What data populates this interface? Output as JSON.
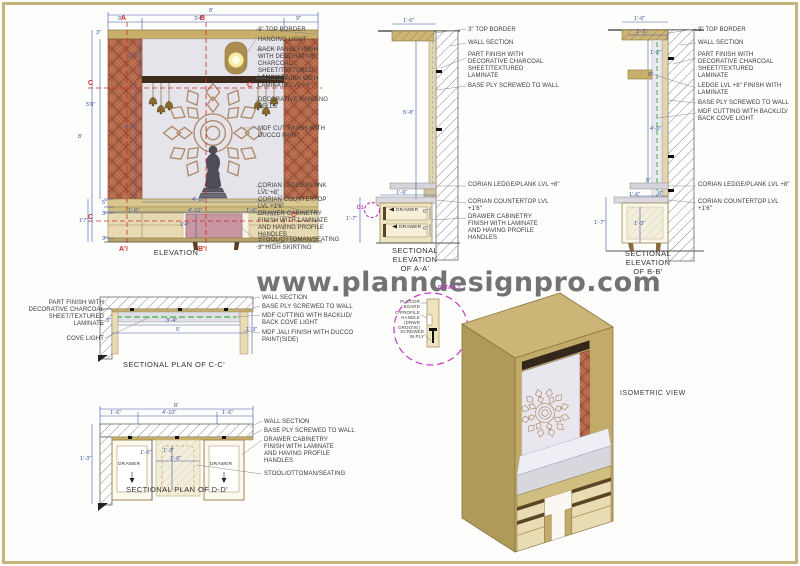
{
  "watermark": "www.planndesignpro.com",
  "colors": {
    "sheet_border": "#c7b37c",
    "wood": "#c8b06a",
    "terracotta": "#b5684a",
    "back_panel": "#e4e4ea",
    "stool_pink": "#c997a2",
    "dim_blue": "#3c55a5",
    "marker_red": "#cc2a2a",
    "cove_green": "#5cbb5c",
    "detail_magenta": "#c03cc0"
  },
  "annotations": {
    "elevation": [
      {
        "n": "elev-label-top-border",
        "t": "3\" TOP BORDER",
        "x": 258,
        "y": 27,
        "w": 76
      },
      {
        "n": "elev-label-hanging-light",
        "t": "HANGING LIGHT",
        "x": 258,
        "y": 37,
        "w": 76
      },
      {
        "n": "elev-label-back-panel",
        "t": "BACK PANEL FINISH WITH DECORATIVE CHARCOAL SHEET/TEXTURED LAMINATE",
        "x": 258,
        "y": 47,
        "w": 76
      },
      {
        "n": "elev-label-ledge",
        "t": "LEDGE FINISH WITH LAMINATE LVL +8\"",
        "x": 258,
        "y": 76,
        "w": 76
      },
      {
        "n": "elev-label-bells",
        "t": "DECORATIVE HANGING BELLS",
        "x": 258,
        "y": 97,
        "w": 76
      },
      {
        "n": "elev-label-mdf-cut",
        "t": "MDF CUT FINISH WITH DUCCO PAINT",
        "x": 258,
        "y": 126,
        "w": 76
      },
      {
        "n": "elev-label-corian-ledge",
        "t": "CORIAN LEDGE/PLANK LVL +8\"",
        "x": 258,
        "y": 183,
        "w": 76
      },
      {
        "n": "elev-label-corian-countertop",
        "t": "CORIAN COUNTERTOP LVL +1'6\"",
        "x": 258,
        "y": 197,
        "w": 76
      },
      {
        "n": "elev-label-drawer-cabinetry",
        "t": "DRAWER CABINETRY FINISH WITH LAMINATE AND HAVING PROFILE HANDLES",
        "x": 258,
        "y": 211,
        "w": 72
      },
      {
        "n": "elev-label-stool",
        "t": "STOOL/OTTOMAN/SEATING",
        "x": 258,
        "y": 237,
        "w": 92
      },
      {
        "n": "elev-label-skirting",
        "t": "3\" HIGH SKIRTING",
        "x": 258,
        "y": 245,
        "w": 92
      },
      {
        "n": "elev-title",
        "t": "ELEVATION",
        "x": 141,
        "y": 249,
        "w": 70,
        "c": "title"
      },
      {
        "n": "elev-dim-total-width",
        "t": "8'",
        "x": 209,
        "y": 8,
        "c": "dim"
      },
      {
        "n": "elev-dim-left-col",
        "t": "9\"",
        "x": 118,
        "y": 16,
        "c": "dim"
      },
      {
        "n": "elev-dim-niche",
        "t": "3'4\"",
        "x": 194,
        "y": 16,
        "c": "dim"
      },
      {
        "n": "elev-dim-right-col",
        "t": "9\"",
        "x": 296,
        "y": 16,
        "c": "dim"
      },
      {
        "n": "elev-dim-border",
        "t": "3\"",
        "x": 96,
        "y": 30,
        "c": "dim"
      },
      {
        "n": "elev-dim-upper",
        "t": "1'-2\"",
        "x": 128,
        "y": 53,
        "c": "dim"
      },
      {
        "n": "elev-dim-58",
        "t": "5'8\"",
        "x": 86,
        "y": 102,
        "c": "dim"
      },
      {
        "n": "elev-dim-47",
        "t": "4'-7\"",
        "x": 124,
        "y": 124,
        "c": "dim"
      },
      {
        "n": "elev-dim-height",
        "t": "8'",
        "x": 78,
        "y": 134,
        "c": "dim"
      },
      {
        "n": "elev-dim-17",
        "t": "1'7\"",
        "x": 79,
        "y": 218,
        "c": "dim"
      },
      {
        "n": "elev-dim-5",
        "t": "5\"",
        "x": 102,
        "y": 200,
        "c": "dim"
      },
      {
        "n": "elev-dim-3a",
        "t": "3\"",
        "x": 102,
        "y": 211,
        "c": "dim"
      },
      {
        "n": "elev-dim-3b",
        "t": "3\"",
        "x": 102,
        "y": 236,
        "c": "dim"
      },
      {
        "n": "elev-dim-ledge-width",
        "t": "4'-10\"",
        "x": 192,
        "y": 197,
        "c": "dim"
      },
      {
        "n": "elev-dim-left-seg",
        "t": "1'-6\"",
        "x": 128,
        "y": 208,
        "c": "dim"
      },
      {
        "n": "elev-dim-mid-seg",
        "t": "4'-10\"",
        "x": 188,
        "y": 208,
        "c": "dim"
      },
      {
        "n": "elev-dim-right-seg",
        "t": "1'-6\"",
        "x": 246,
        "y": 208,
        "c": "dim"
      },
      {
        "n": "elev-dim-stool-height",
        "t": "1'4\"",
        "x": 180,
        "y": 222,
        "c": "dim"
      },
      {
        "n": "elev-marker-a",
        "t": "A",
        "x": 121,
        "y": 15,
        "c": "marker"
      },
      {
        "n": "elev-marker-b",
        "t": "B",
        "x": 200,
        "y": 15,
        "c": "marker"
      },
      {
        "n": "elev-marker-a2",
        "t": "A'",
        "x": 119,
        "y": 246,
        "c": "marker"
      },
      {
        "n": "elev-marker-b2",
        "t": "B'",
        "x": 198,
        "y": 246,
        "c": "marker"
      },
      {
        "n": "elev-marker-c",
        "t": "C",
        "x": 88,
        "y": 80,
        "c": "marker"
      },
      {
        "n": "elev-marker-c2",
        "t": "C'",
        "x": 247,
        "y": 82,
        "c": "marker"
      },
      {
        "n": "elev-marker-c3",
        "t": "C",
        "x": 88,
        "y": 214,
        "c": "marker"
      },
      {
        "n": "elev-marker-c4",
        "t": "C'",
        "x": 291,
        "y": 212,
        "c": "marker"
      }
    ],
    "section_aa": [
      {
        "n": "aa-label-top-border",
        "t": "3\" TOP BORDER",
        "x": 468,
        "y": 27,
        "w": 96
      },
      {
        "n": "aa-label-wall-section",
        "t": "WALL SECTION",
        "x": 468,
        "y": 40,
        "w": 96
      },
      {
        "n": "aa-label-part-finish",
        "t": "PART FINISH WITH DECORATIVE CHARCOAL SHEET/TEXTURED LAMINATE",
        "x": 468,
        "y": 52,
        "w": 80
      },
      {
        "n": "aa-label-base-ply",
        "t": "BASE PLY SCREWED TO WALL",
        "x": 468,
        "y": 83,
        "w": 102
      },
      {
        "n": "aa-label-corian-ledge",
        "t": "CORIAN LEDGE/PLANK LVL +8\"",
        "x": 468,
        "y": 182,
        "w": 92
      },
      {
        "n": "aa-label-corian-countertop",
        "t": "CORIAN COUNTERTOP LVL +1'6\"",
        "x": 468,
        "y": 199,
        "w": 95
      },
      {
        "n": "aa-label-drawer-cabinetry",
        "t": "DRAWER CABINETRY FINISH WITH LAMINATE AND HAVING PROFILE HANDLES",
        "x": 468,
        "y": 214,
        "w": 84
      },
      {
        "n": "aa-title",
        "t": "SECTIONAL\nELEVATION\nOF A-A'",
        "x": 384,
        "y": 247,
        "w": 62,
        "c": "title"
      },
      {
        "n": "aa-dim-top",
        "t": "1'-6\"",
        "x": 403,
        "y": 18,
        "c": "dim"
      },
      {
        "n": "aa-dim-height",
        "t": "5'-8\"",
        "x": 403,
        "y": 110,
        "c": "dim"
      },
      {
        "n": "aa-dim-counter",
        "t": "1'-6\"",
        "x": 396,
        "y": 190,
        "c": "dim"
      },
      {
        "n": "aa-dim-drawer1",
        "t": "6\"",
        "x": 423,
        "y": 209,
        "c": "dim"
      },
      {
        "n": "aa-dim-drawer2",
        "t": "6\"",
        "x": 423,
        "y": 226,
        "c": "dim"
      },
      {
        "n": "aa-dim-cab-height",
        "t": "1'-7\"",
        "x": 346,
        "y": 216,
        "c": "dim"
      },
      {
        "n": "aa-drawer-text-1",
        "t": "DRAWER",
        "x": 396,
        "y": 208,
        "c": "drawer"
      },
      {
        "n": "aa-drawer-text-2",
        "t": "DRAWER",
        "x": 399,
        "y": 225,
        "c": "drawer"
      },
      {
        "n": "aa-detail-marker-d1",
        "t": "D1",
        "x": 357,
        "y": 206,
        "c": "mag"
      }
    ],
    "section_bb": [
      {
        "n": "bb-label-top-border",
        "t": "3\" TOP BORDER",
        "x": 698,
        "y": 27,
        "w": 100
      },
      {
        "n": "bb-label-wall-section",
        "t": "WALL SECTION",
        "x": 698,
        "y": 40,
        "w": 100
      },
      {
        "n": "bb-label-part-finish",
        "t": "PART FINISH WITH DECORATIVE CHARCOAL SHEET/TEXTURED LAMINATE",
        "x": 698,
        "y": 52,
        "w": 82
      },
      {
        "n": "bb-label-ledge",
        "t": "LEDGE LVL +8\" FINISH WITH LAMINATE",
        "x": 698,
        "y": 83,
        "w": 96
      },
      {
        "n": "bb-label-base-ply",
        "t": "BASE PLY SCREWED TO WALL",
        "x": 698,
        "y": 100,
        "w": 110
      },
      {
        "n": "bb-label-mdf-cutting",
        "t": "MDF CUTTING WITH BACKLID/ BACK COVE LIGHT",
        "x": 698,
        "y": 109,
        "w": 106
      },
      {
        "n": "bb-label-corian-ledge",
        "t": "CORIAN LEDGE/PLANK LVL +8\"",
        "x": 698,
        "y": 182,
        "w": 95
      },
      {
        "n": "bb-label-corian-countertop",
        "t": "CORIAN COUNTERTOP LVL +1'6\"",
        "x": 698,
        "y": 199,
        "w": 95
      },
      {
        "n": "bb-title",
        "t": "SECTIONAL\nELEVATION\nOF B-B'",
        "x": 617,
        "y": 250,
        "w": 62,
        "c": "title"
      },
      {
        "n": "bb-dim-16-top",
        "t": "1'-6\"",
        "x": 634,
        "y": 16,
        "c": "dim"
      },
      {
        "n": "bb-dim-13-top",
        "t": "1'-3\"",
        "x": 636,
        "y": 29,
        "c": "dim"
      },
      {
        "n": "bb-dim-12",
        "t": "1'-2\"",
        "x": 650,
        "y": 50,
        "c": "dim"
      },
      {
        "n": "bb-dim-8-ledge",
        "t": "8\"",
        "x": 648,
        "y": 72,
        "c": "dim"
      },
      {
        "n": "bb-dim-40",
        "t": "4'-0\"",
        "x": 650,
        "y": 126,
        "c": "dim"
      },
      {
        "n": "bb-dim-8-low",
        "t": "8\"",
        "x": 646,
        "y": 178,
        "c": "dim"
      },
      {
        "n": "bb-dim-6",
        "t": "6\"",
        "x": 658,
        "y": 191,
        "c": "dim"
      },
      {
        "n": "bb-dim-16-counter",
        "t": "1'-6\"",
        "x": 629,
        "y": 192,
        "c": "dim"
      },
      {
        "n": "bb-dim-17",
        "t": "1'-7\"",
        "x": 594,
        "y": 220,
        "c": "dim"
      },
      {
        "n": "bb-dim-13-cab",
        "t": "1'-3\"",
        "x": 634,
        "y": 221,
        "c": "dim"
      }
    ],
    "plan_cc": [
      {
        "n": "cc-label-part-finish",
        "t": "PART FINISH WITH DECORATIVE CHARCOAL SHEET/TEXTURED LAMINATE",
        "x": 26,
        "y": 300,
        "w": 78,
        "c": "lblr"
      },
      {
        "n": "cc-label-cove-light",
        "t": "COVE LIGHT",
        "x": 58,
        "y": 336,
        "w": 46,
        "c": "lblr"
      },
      {
        "n": "cc-label-wall-section",
        "t": "WALL SECTION",
        "x": 262,
        "y": 295,
        "w": 105
      },
      {
        "n": "cc-label-base-ply",
        "t": "BASE PLY SCREWED TO WALL",
        "x": 262,
        "y": 304,
        "w": 110
      },
      {
        "n": "cc-label-mdf-cutting",
        "t": "MDF CUTTING WITH BACKLID/ BACK COVE LIGHT",
        "x": 262,
        "y": 313,
        "w": 100
      },
      {
        "n": "cc-label-mdf-jali",
        "t": "MDF JALI FINISH WITH DUCCO PAINT(SIDE)",
        "x": 262,
        "y": 330,
        "w": 100
      },
      {
        "n": "cc-title",
        "t": "SECTIONAL PLAN OF C-C'",
        "x": 112,
        "y": 361,
        "w": 124,
        "c": "title"
      },
      {
        "n": "cc-dim-34",
        "t": "3'-4\"",
        "x": 166,
        "y": 318,
        "c": "dim"
      },
      {
        "n": "cc-dim-5",
        "t": "5'",
        "x": 176,
        "y": 327,
        "c": "dim"
      },
      {
        "n": "cc-dim-3",
        "t": "3\"",
        "x": 106,
        "y": 318,
        "c": "dim"
      },
      {
        "n": "cc-dim-13",
        "t": "1'-3\"",
        "x": 246,
        "y": 327,
        "c": "dim"
      }
    ],
    "detail1": [
      {
        "n": "detail1-title",
        "t": "DETAIL 1",
        "x": 438,
        "y": 286,
        "c": "mag"
      },
      {
        "n": "detail1-label-ply-board",
        "t": "PLY/CDR BOARD",
        "x": 392,
        "y": 300,
        "w": 28,
        "c": "tiny"
      },
      {
        "n": "detail1-label-c-profile",
        "t": "C-PROFILE HANDLE (DRWR GROOVE)",
        "x": 386,
        "y": 311,
        "w": 34,
        "c": "tiny"
      },
      {
        "n": "detail1-label-screwed",
        "t": "SCREWED IN PLY",
        "x": 398,
        "y": 330,
        "w": 26,
        "c": "tiny"
      }
    ],
    "plan_dd": [
      {
        "n": "dd-label-wall-section",
        "t": "WALL SECTION",
        "x": 264,
        "y": 419,
        "w": 105
      },
      {
        "n": "dd-label-base-ply",
        "t": "BASE PLY SCREWED TO WALL",
        "x": 264,
        "y": 428,
        "w": 112
      },
      {
        "n": "dd-label-drawer-cabinetry",
        "t": "DRAWER CABINETRY FINISH WITH LAMINATE AND HAVING PROFILE HANDLES",
        "x": 264,
        "y": 437,
        "w": 82
      },
      {
        "n": "dd-label-stool",
        "t": "STOOL/OTTOMAN/SEATING",
        "x": 264,
        "y": 471,
        "w": 112
      },
      {
        "n": "dd-title",
        "t": "SECTIONAL PLAN OF D-D'",
        "x": 114,
        "y": 486,
        "w": 126,
        "c": "title"
      },
      {
        "n": "dd-dim-total",
        "t": "8'",
        "x": 174,
        "y": 403,
        "c": "dim"
      },
      {
        "n": "dd-dim-left",
        "t": "1'-6\"",
        "x": 110,
        "y": 410,
        "c": "dim"
      },
      {
        "n": "dd-dim-mid",
        "t": "4'-10\"",
        "x": 162,
        "y": 410,
        "c": "dim"
      },
      {
        "n": "dd-dim-right",
        "t": "1'-6\"",
        "x": 222,
        "y": 410,
        "c": "dim"
      },
      {
        "n": "dd-dim-depth",
        "t": "1'-3\"",
        "x": 80,
        "y": 456,
        "c": "dim"
      },
      {
        "n": "dd-dim-16a",
        "t": "1'-6\"",
        "x": 140,
        "y": 450,
        "c": "dim"
      },
      {
        "n": "dd-dim-13",
        "t": "1'-3\"",
        "x": 163,
        "y": 448,
        "c": "dim"
      },
      {
        "n": "dd-dim-16b",
        "t": "1'-6\"",
        "x": 170,
        "y": 456,
        "c": "dim"
      },
      {
        "n": "dd-drawer-text-1",
        "t": "DRAWER",
        "x": 118,
        "y": 462,
        "c": "drawer"
      },
      {
        "n": "dd-drawer-text-2",
        "t": "DRAWER",
        "x": 210,
        "y": 462,
        "c": "drawer"
      }
    ],
    "isometric": [
      {
        "n": "iso-title",
        "t": "ISOMETRIC VIEW",
        "x": 620,
        "y": 390,
        "c": "md"
      }
    ]
  }
}
